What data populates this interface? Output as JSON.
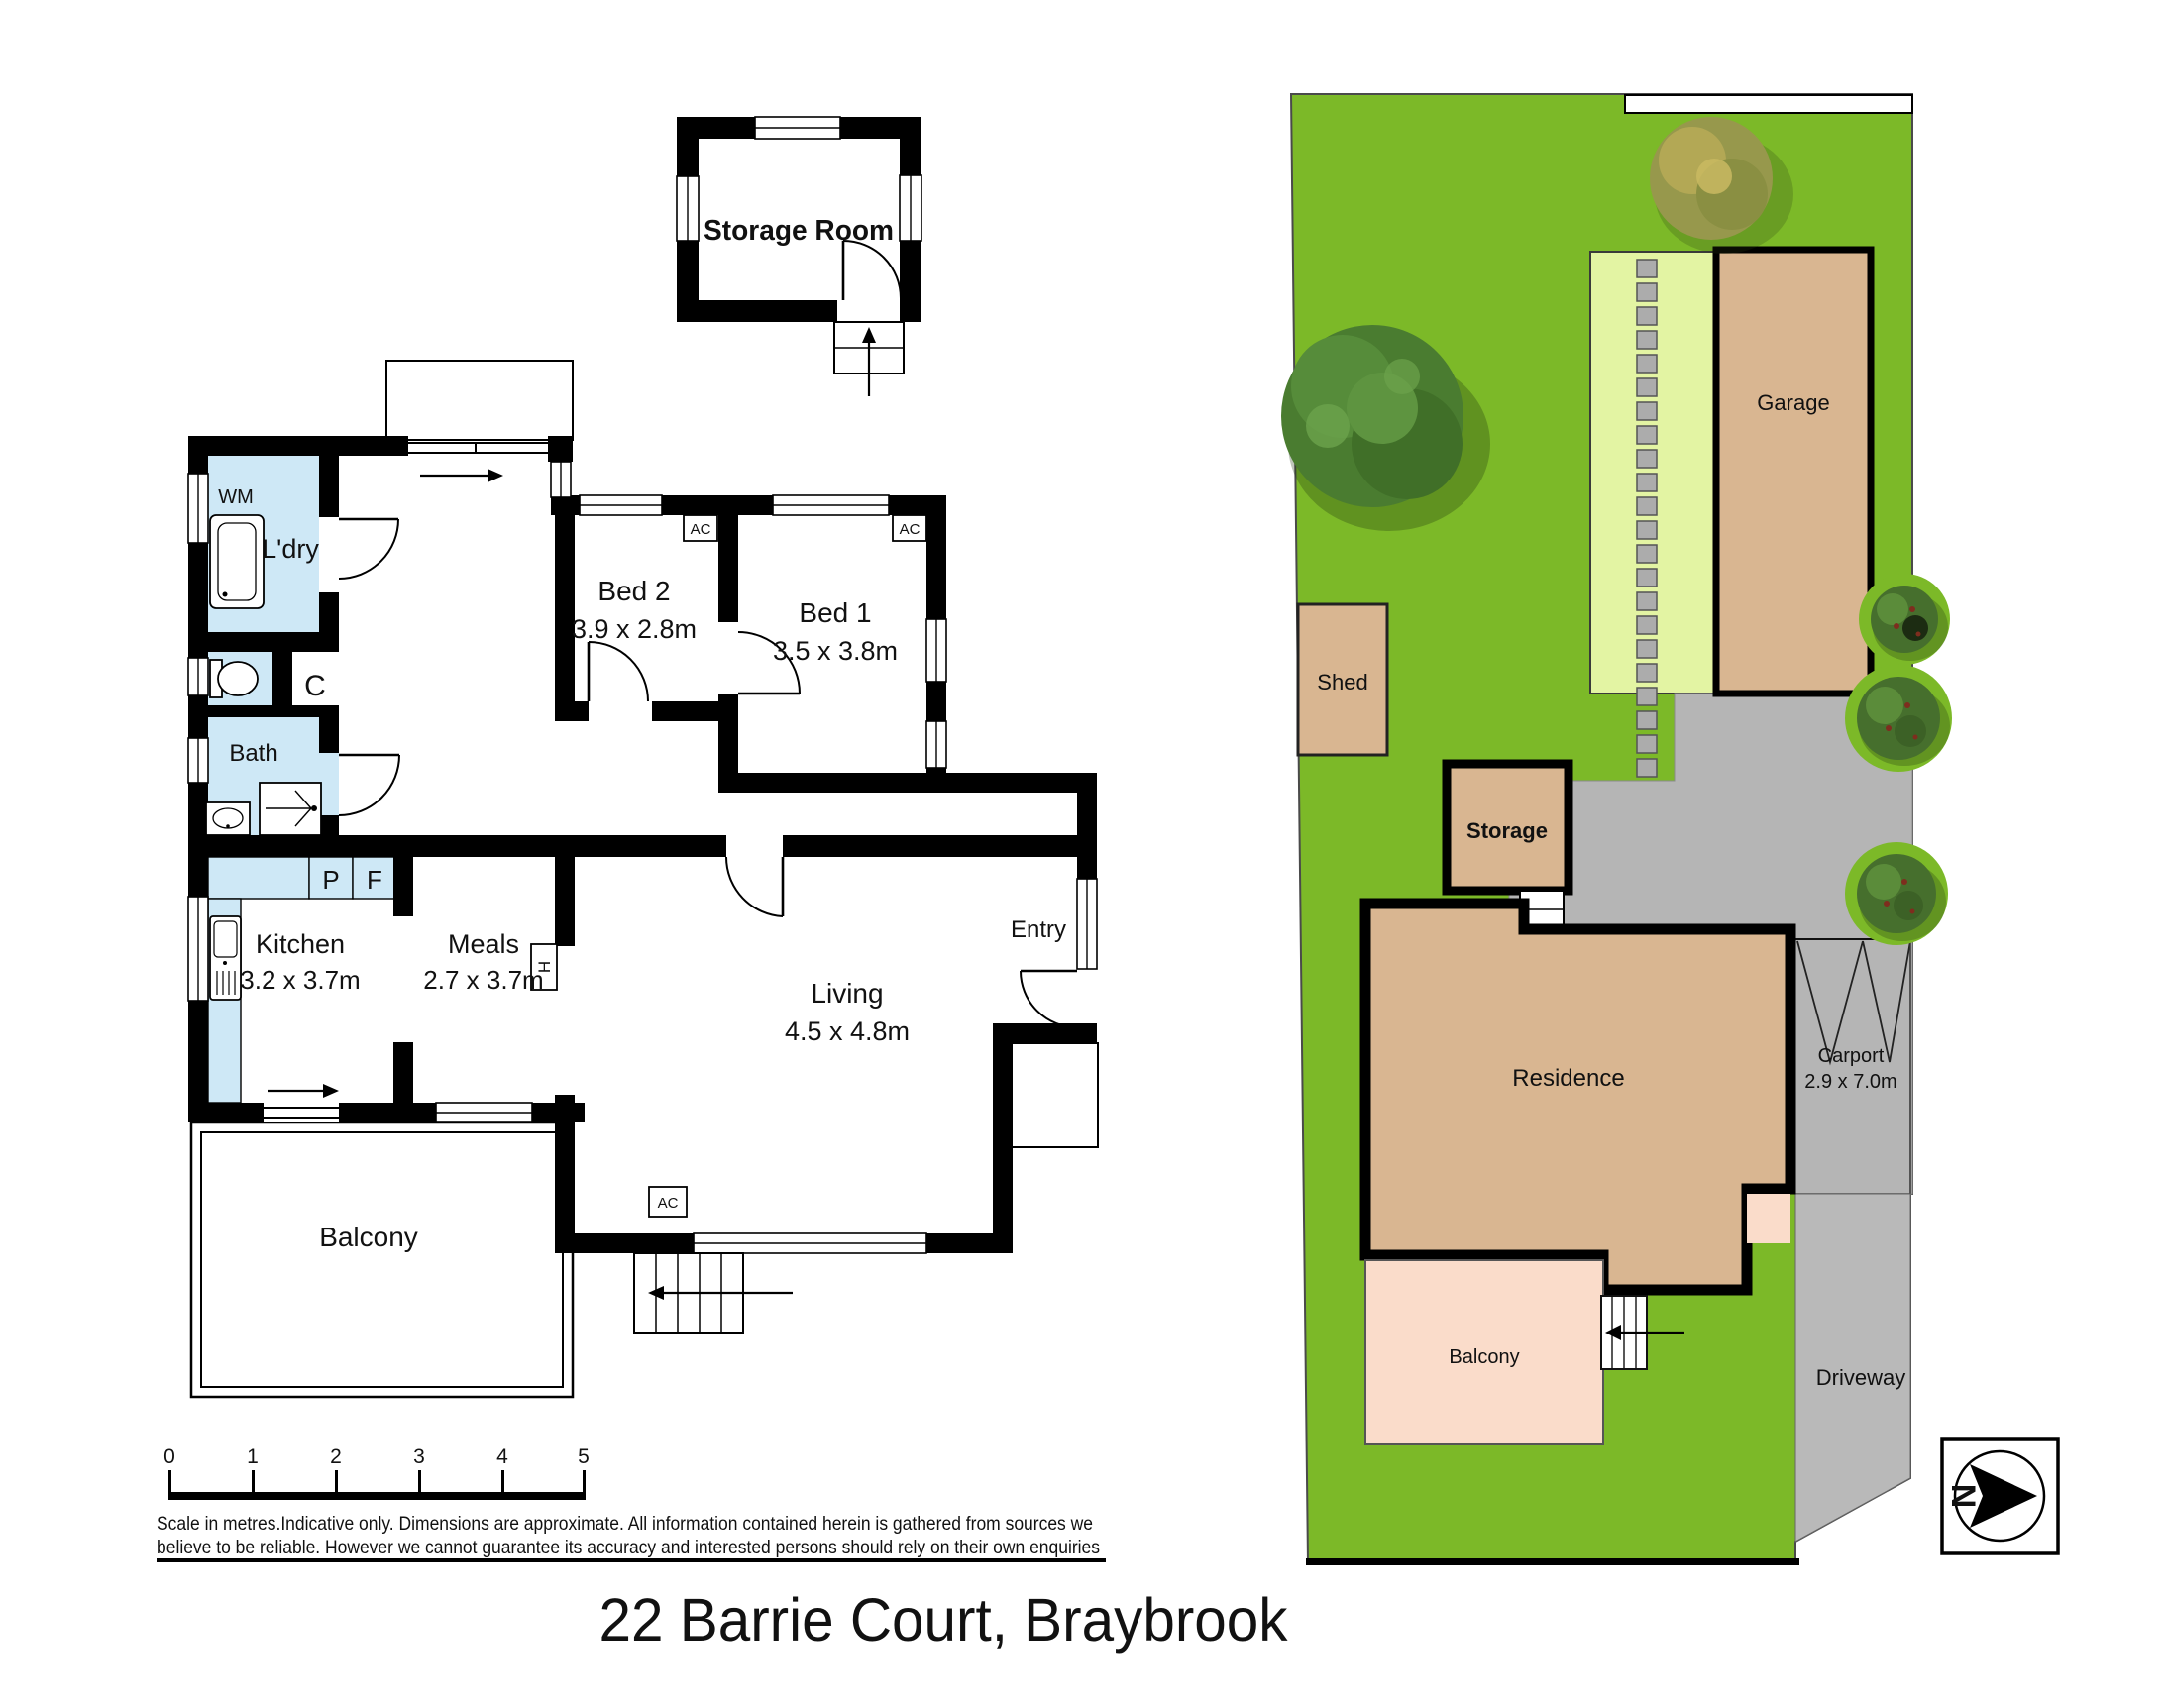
{
  "title": "22 Barrie Court, Braybrook",
  "disclaimer": {
    "line1": "Scale in metres.Indicative only. Dimensions are approximate. All information contained herein is gathered from sources we",
    "line2": "believe to be reliable. However we cannot guarantee its accuracy and interested persons should rely on their own enquiries"
  },
  "scale_ticks": [
    "0",
    "1",
    "2",
    "3",
    "4",
    "5"
  ],
  "floor_plan": {
    "storage_room": {
      "label": "Storage Room"
    },
    "rooms": {
      "ldry": {
        "label": "L'dry"
      },
      "bath": {
        "label": "Bath"
      },
      "bed2": {
        "label": "Bed 2",
        "dims": "3.9 x 2.8m"
      },
      "bed1": {
        "label": "Bed 1",
        "dims": "3.5 x 3.8m"
      },
      "kitchen": {
        "label": "Kitchen",
        "dims": "3.2 x 3.7m"
      },
      "meals": {
        "label": "Meals",
        "dims": "2.7 x 3.7m"
      },
      "living": {
        "label": "Living",
        "dims": "4.5 x 4.8m"
      },
      "entry": {
        "label": "Entry"
      },
      "balcony": {
        "label": "Balcony"
      }
    },
    "markers": {
      "wm": "WM",
      "cupboard": "C",
      "pantry": "P",
      "fridge": "F",
      "heater": "H",
      "ac": "AC"
    }
  },
  "site_plan": {
    "garage": {
      "label": "Garage"
    },
    "shed": {
      "label": "Shed"
    },
    "storage": {
      "label": "Storage"
    },
    "residence": {
      "label": "Residence"
    },
    "carport": {
      "label": "Carport",
      "dims": "2.9 x 7.0m"
    },
    "balcony": {
      "label": "Balcony"
    },
    "driveway": {
      "label": "Driveway"
    },
    "compass": {
      "north": "N"
    }
  },
  "colors": {
    "lawn": "#7CB928",
    "garden_bed": "#E3F4A3",
    "building_tan": "#D9B691",
    "balcony_pink": "#FADCCA",
    "paving_gray": "#B5B5B5",
    "wet_area_blue": "#CEE8F6"
  }
}
